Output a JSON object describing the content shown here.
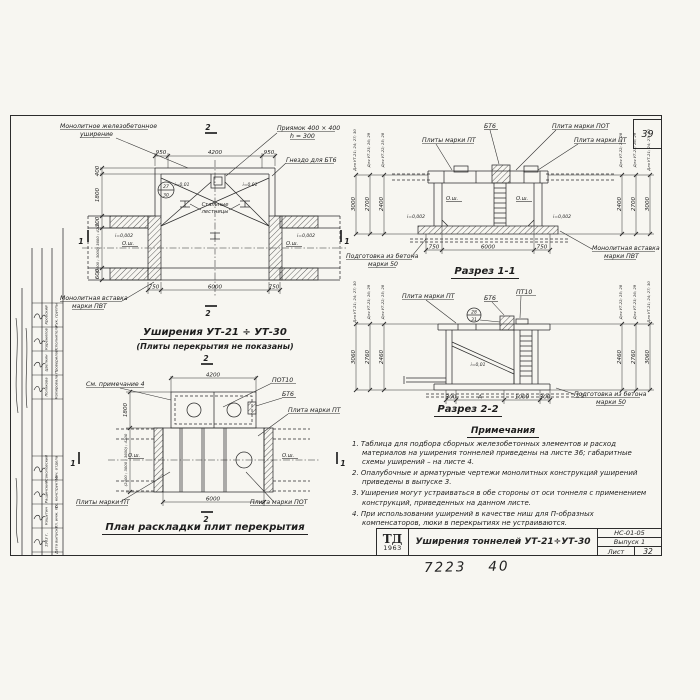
{
  "sheet": {
    "corner_number": "39",
    "footer_left": "7223",
    "footer_right": "40"
  },
  "left_stamp": {
    "rows_upper": [
      {
        "role": "Рук. группы",
        "name": "Кробский"
      },
      {
        "role": "Исполнитель",
        "name": "Коренилов"
      },
      {
        "role": "Проверила",
        "name": "Цветкин"
      },
      {
        "role": "Копировала",
        "name": "Полякова"
      }
    ],
    "rows_lower": [
      {
        "role": "Нач. отдела",
        "name": "Соколовский"
      },
      {
        "role": "Гл. конструктор",
        "name": "Ращинский"
      },
      {
        "role": "Гл. инж. пр.",
        "name": "Кошутин"
      },
      {
        "role": "Дата выпуска",
        "name": "1963 г."
      }
    ]
  },
  "plan_top": {
    "title": "Уширения УТ-21 ÷ УТ-30",
    "subtitle": "(Плиты перекрытия не показаны)",
    "labels": {
      "monolithic": [
        "Монолитное железобетонное",
        "уширение"
      ],
      "pit": [
        "Приямок 400 × 400",
        "h = 300"
      ],
      "socket": "Гнездо для БТ6",
      "stairs": [
        "Стальные",
        "лестницы"
      ],
      "insert": [
        "Монолитная вставка",
        "марки ПВТ"
      ]
    },
    "axis": "О.ш.",
    "slopes": {
      "side": "i=0,002",
      "top": "i=0,01"
    },
    "detail": {
      "top": "27",
      "bottom": "30"
    },
    "dims": {
      "top": [
        "950",
        "4200",
        "950"
      ],
      "bottom": [
        "750",
        "6000",
        "750"
      ],
      "left": [
        "400",
        "1800",
        "300",
        "(2400 ; 3000) 3600 ; 4200",
        "600"
      ]
    },
    "marks": {
      "one": "1",
      "two": "2"
    }
  },
  "section1": {
    "title": "Разрез 1-1",
    "labels": {
      "bt6": "БТ6",
      "plate_pot": "Плита марки ПОТ",
      "plates_pt": "Плиты марки ПТ",
      "plate_pt": "Плита марки ПТ",
      "prep": [
        "Подготовка из бетона",
        "марки 50"
      ],
      "insert": [
        "Монолитная вставка",
        "марки ПВТ"
      ]
    },
    "axis": "О.ш.",
    "slope": "i=0,002",
    "dims_bottom": [
      "750",
      "6000",
      "750"
    ],
    "heights_left": [
      {
        "label": "Для УТ-21; 24; 27; 30",
        "value": "3000"
      },
      {
        "label": "Для УТ-23; 26; 29",
        "value": "2700"
      },
      {
        "label": "Для УТ-22; 25; 28",
        "value": "2400"
      }
    ],
    "heights_right": [
      {
        "label": "Для УТ-22; 25; 28",
        "value": "2400"
      },
      {
        "label": "Для УТ-23; 26; 29",
        "value": "2700"
      },
      {
        "label": "Для УТ-21; 24; 27; 30",
        "value": "3000"
      }
    ]
  },
  "section2": {
    "title": "Разрез 2-2",
    "labels": {
      "plate_pt": "Плита марки ПТ",
      "bt6": "БТ6",
      "pt10": "ПТ10",
      "prep": [
        "Подготовка из бетона",
        "марки 50"
      ]
    },
    "slope": "i=0,01",
    "detail": {
      "top": "28",
      "bottom": "31"
    },
    "dims_bottom": [
      "300",
      "А",
      "1000",
      "300"
    ],
    "heights_left": [
      {
        "label": "Для УТ-21; 24; 27; 30",
        "value": "3060"
      },
      {
        "label": "Для УТ-23; 26; 29",
        "value": "2760"
      },
      {
        "label": "Для УТ-22; 25; 28",
        "value": "2460"
      }
    ],
    "heights_right": [
      {
        "label": "Для УТ-22; 25; 28",
        "value": "2460"
      },
      {
        "label": "Для УТ-23; 26; 29",
        "value": "2760"
      },
      {
        "label": "Для УТ-21; 24; 27; 30",
        "value": "3060"
      }
    ]
  },
  "plan_bottom": {
    "title": "План раскладки плит перекрытия",
    "labels": {
      "note4": "См. примечание 4",
      "pot10": "ПОТ10",
      "bt6": "БТ6",
      "plate_pt": "Плита марки ПТ",
      "plates_pt": "Плиты марки ПТ",
      "plate_pot": "Плита марки ПОТ"
    },
    "axis": "О.ш.",
    "dims": {
      "top": "4200",
      "bottom": "6000",
      "left_upper": "1800",
      "left_lower": "(2400 ; 3000 ; 3600) ; 4200"
    },
    "marks": {
      "one": "1",
      "two": "2"
    }
  },
  "notes": {
    "title": "Примечания",
    "items": [
      "1. Таблица для подбора сборных железобетонных элементов и расход материалов на уширения тоннелей приведены на листе 36; габаритные схемы уширений – на листе 4.",
      "2. Опалубочные и арматурные чертежи монолитных конструкций уширений приведены в выпуске 3.",
      "3. Уширения могут устраиваться в обе стороны от оси тоннеля с применением конструкций, приведенных на данном листе.",
      "4. При использовании уширений в качестве ниш для П-образных компенсаторов, люки в перекрытиях не устраиваются."
    ]
  },
  "title_block": {
    "logo_top": "ТД",
    "logo_bottom": "1963",
    "title": "Уширения тоннелей УТ-21÷УТ-30",
    "doc_number": "НС-01-05",
    "issue": "Выпуск 1",
    "sheet_label": "Лист",
    "sheet_number": "32"
  }
}
